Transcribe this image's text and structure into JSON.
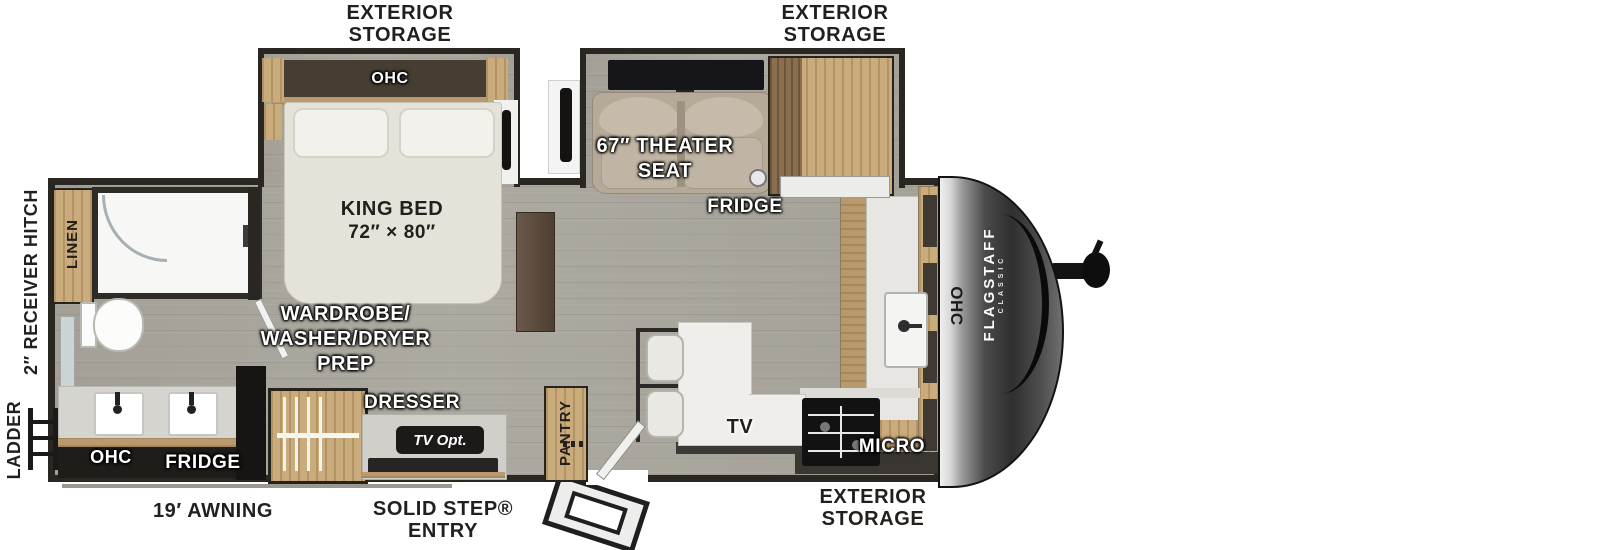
{
  "labels": {
    "exterior_storage_top_left": {
      "line1": "EXTERIOR",
      "line2": "STORAGE"
    },
    "exterior_storage_top_right": {
      "line1": "EXTERIOR",
      "line2": "STORAGE"
    },
    "exterior_storage_bottom": {
      "line1": "EXTERIOR",
      "line2": "STORAGE"
    },
    "awning": "19′ AWNING",
    "solid_step": {
      "line1": "SOLID STEP®",
      "line2": "ENTRY"
    },
    "receiver_hitch": "2″ RECEIVER HITCH",
    "ladder": "LADDER",
    "linen": "LINEN",
    "ohc_bedroom": "OHC",
    "king_bed": {
      "line1": "KING BED",
      "line2": "72″ × 80″"
    },
    "theater_seat": {
      "line1": "67″ THEATER",
      "line2": "SEAT"
    },
    "fridge_kitchen": "FRIDGE",
    "ohc_rear": "OHC",
    "fridge_rear": "FRIDGE",
    "wardrobe": {
      "line1": "WARDROBE/",
      "line2": "WASHER/DRYER",
      "line3": "PREP"
    },
    "dresser": "DRESSER",
    "tv_opt": "TV Opt.",
    "pantry": "PANTRY",
    "tv_island": "TV",
    "micro": "MICRO",
    "ohc_kitchen": "OHC",
    "brand": {
      "name": "FLAGSTAFF",
      "sub": "CLASSIC"
    }
  },
  "colors": {
    "wall": "#2a2723",
    "wood": "#c9ab7c",
    "floor": "#adaaa1",
    "bed": "#e5e2d9",
    "seat": "#b5a998",
    "cap_dark": "#2f2f2f",
    "label_dark": "#221f1c",
    "label_white": "#ffffff"
  }
}
